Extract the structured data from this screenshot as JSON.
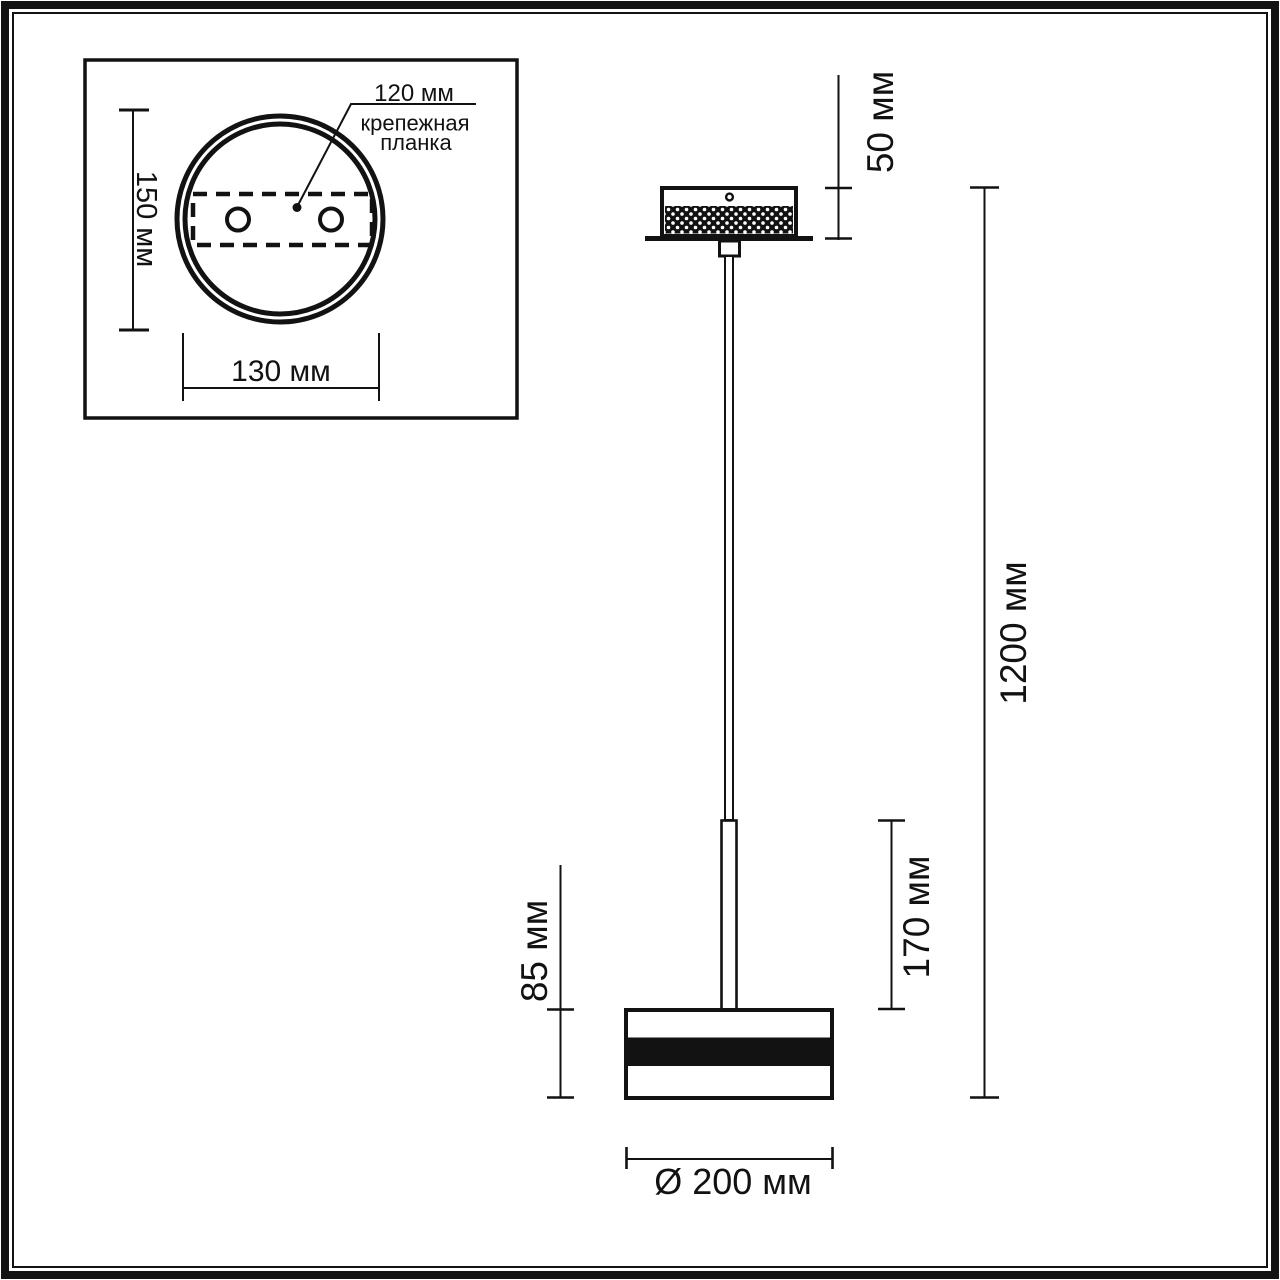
{
  "inset": {
    "height_dim": "150 мм",
    "width_dim": "130 мм",
    "callout_dim": "120 мм",
    "callout_line1": "крепежная",
    "callout_line2": "планка"
  },
  "main": {
    "canopy_height_dim": "50 мм",
    "overall_height_dim": "1200 мм",
    "rod_dim": "170 мм",
    "shade_height_dim": "85 мм",
    "shade_diameter_dim": "Ø 200 мм"
  },
  "colors": {
    "ink": "#121212",
    "paper": "#ffffff"
  }
}
